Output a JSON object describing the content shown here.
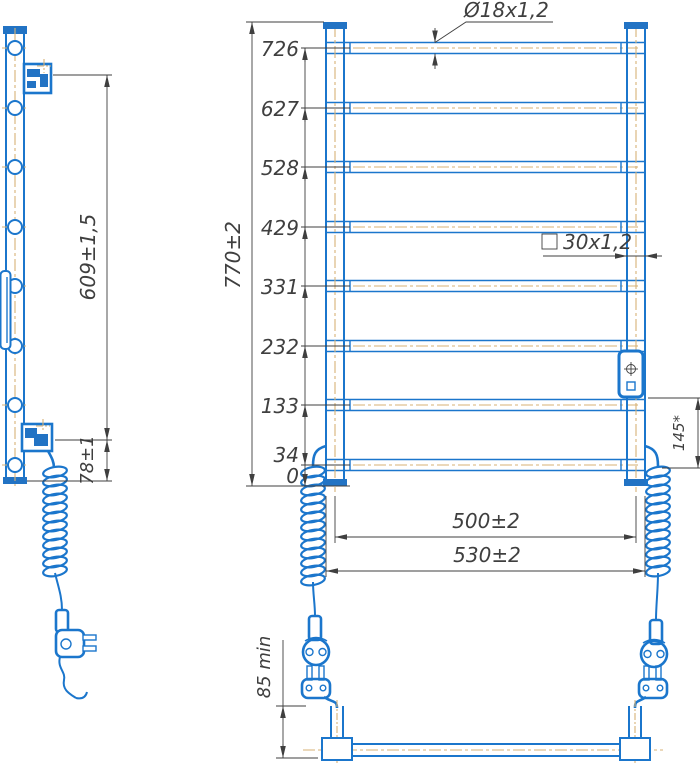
{
  "document": {
    "type": "technical-drawing",
    "subject": "ladder-style electric towel warmer, three projections with dimensions"
  },
  "colors": {
    "product_line_blue": "#1b76cc",
    "product_fill_blue": "#2273c4",
    "centerline_tan": "#d7b276",
    "dimension_gray": "#3f3f3f",
    "background": "#ffffff"
  },
  "labels": {
    "heights": [
      "726",
      "627",
      "528",
      "429",
      "331",
      "232",
      "133",
      "34",
      "0"
    ],
    "overall_height": "770±2",
    "mount_span": "609±1,5",
    "mount_bottom_offset": "78±1",
    "round_tube": "Ø18x1,2",
    "square_tube": "30x1,2",
    "axis_width": "500±2",
    "overall_width": "530±2",
    "outlet_offset": "145*",
    "plug_clearance": "85 min"
  }
}
